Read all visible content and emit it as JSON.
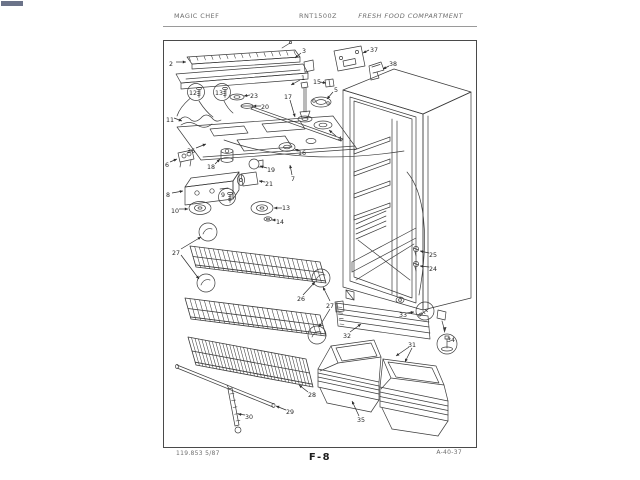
{
  "header": {
    "left": "MAGIC CHEF",
    "center": "RNT1500Z",
    "right": "FRESH FOOD COMPARTMENT"
  },
  "footer": {
    "left": "119.853  5/87",
    "center": "F-8",
    "right": "A-40-37"
  },
  "diagram": {
    "callouts": [
      {
        "n": "2",
        "x": 171,
        "y": 64,
        "leads": [
          [
            176,
            62,
            186,
            62
          ]
        ]
      },
      {
        "n": "3",
        "x": 304,
        "y": 51,
        "leads": [
          [
            301,
            53,
            295,
            58
          ]
        ]
      },
      {
        "n": "1",
        "x": 303,
        "y": 78,
        "leads": [
          [
            300,
            80,
            291,
            85
          ]
        ]
      },
      {
        "n": "37",
        "x": 374,
        "y": 50,
        "leads": [
          [
            369,
            50,
            363,
            53
          ]
        ]
      },
      {
        "n": "38",
        "x": 393,
        "y": 64,
        "leads": [
          [
            389,
            66,
            383,
            69
          ]
        ]
      },
      {
        "n": "15",
        "x": 317,
        "y": 82,
        "leads": [
          [
            320,
            82,
            326,
            83
          ]
        ]
      },
      {
        "n": "5",
        "x": 336,
        "y": 90,
        "leads": [
          [
            333,
            92,
            327,
            99
          ]
        ]
      },
      {
        "n": "12",
        "x": 193,
        "y": 93
      },
      {
        "n": "13",
        "x": 219,
        "y": 93
      },
      {
        "n": "23",
        "x": 254,
        "y": 96,
        "leads": [
          [
            250,
            95,
            244,
            96
          ]
        ]
      },
      {
        "n": "20",
        "x": 265,
        "y": 107,
        "leads": [
          [
            261,
            106,
            253,
            106
          ]
        ]
      },
      {
        "n": "17",
        "x": 288,
        "y": 97,
        "leads": [
          [
            290,
            100,
            295,
            117
          ]
        ]
      },
      {
        "n": "11",
        "x": 170,
        "y": 120,
        "leads": [
          [
            174,
            118,
            182,
            121
          ]
        ]
      },
      {
        "n": "4",
        "x": 340,
        "y": 139,
        "leads": [
          [
            336,
            136,
            329,
            130
          ]
        ]
      },
      {
        "n": "36",
        "x": 191,
        "y": 151,
        "leads": [
          [
            196,
            148,
            206,
            144
          ]
        ]
      },
      {
        "n": "16",
        "x": 302,
        "y": 153,
        "leads": [
          [
            299,
            151,
            295,
            149
          ]
        ]
      },
      {
        "n": "6",
        "x": 167,
        "y": 165,
        "leads": [
          [
            170,
            162,
            177,
            159
          ]
        ]
      },
      {
        "n": "18",
        "x": 211,
        "y": 167,
        "leads": [
          [
            215,
            164,
            220,
            159
          ]
        ]
      },
      {
        "n": "19",
        "x": 271,
        "y": 170,
        "leads": [
          [
            267,
            168,
            260,
            166
          ]
        ]
      },
      {
        "n": "7",
        "x": 293,
        "y": 179,
        "leads": [
          [
            292,
            175,
            290,
            165
          ]
        ]
      },
      {
        "n": "8",
        "x": 168,
        "y": 195,
        "leads": [
          [
            172,
            193,
            183,
            191
          ]
        ]
      },
      {
        "n": "21",
        "x": 269,
        "y": 184,
        "leads": [
          [
            265,
            182,
            259,
            181
          ]
        ]
      },
      {
        "n": "9",
        "x": 223,
        "y": 195
      },
      {
        "n": "10",
        "x": 175,
        "y": 211,
        "leads": [
          [
            179,
            209,
            188,
            209
          ]
        ]
      },
      {
        "n": "13",
        "x": 286,
        "y": 208,
        "leads": [
          [
            282,
            208,
            274,
            208
          ]
        ]
      },
      {
        "n": "14",
        "x": 280,
        "y": 222,
        "leads": [
          [
            276,
            220,
            272,
            220
          ]
        ]
      },
      {
        "n": "27",
        "x": 176,
        "y": 253,
        "leads": [
          [
            181,
            249,
            201,
            237
          ],
          [
            181,
            255,
            199,
            279
          ]
        ]
      },
      {
        "n": "26",
        "x": 301,
        "y": 299,
        "leads": [
          [
            303,
            295,
            315,
            282
          ]
        ]
      },
      {
        "n": "27",
        "x": 330,
        "y": 306,
        "leads": [
          [
            330,
            301,
            323,
            287
          ],
          [
            330,
            309,
            319,
            327
          ]
        ]
      },
      {
        "n": "28",
        "x": 312,
        "y": 395,
        "leads": [
          [
            308,
            392,
            299,
            385
          ]
        ]
      },
      {
        "n": "29",
        "x": 290,
        "y": 412,
        "leads": [
          [
            286,
            410,
            276,
            406
          ]
        ]
      },
      {
        "n": "30",
        "x": 249,
        "y": 417,
        "leads": [
          [
            245,
            415,
            238,
            414
          ]
        ]
      },
      {
        "n": "25",
        "x": 433,
        "y": 255,
        "leads": [
          [
            429,
            253,
            420,
            251
          ]
        ]
      },
      {
        "n": "24",
        "x": 433,
        "y": 269,
        "leads": [
          [
            429,
            267,
            420,
            266
          ]
        ]
      },
      {
        "n": "33",
        "x": 403,
        "y": 315,
        "leads": [
          [
            407,
            313,
            414,
            312
          ]
        ]
      },
      {
        "n": "32",
        "x": 347,
        "y": 336,
        "leads": [
          [
            350,
            332,
            361,
            324
          ]
        ]
      },
      {
        "n": "34",
        "x": 451,
        "y": 340
      },
      {
        "n": "31",
        "x": 412,
        "y": 345,
        "leads": [
          [
            409,
            347,
            396,
            356
          ],
          [
            412,
            348,
            405,
            362
          ]
        ]
      },
      {
        "n": "35",
        "x": 361,
        "y": 420,
        "leads": [
          [
            359,
            416,
            352,
            401
          ]
        ]
      }
    ]
  }
}
